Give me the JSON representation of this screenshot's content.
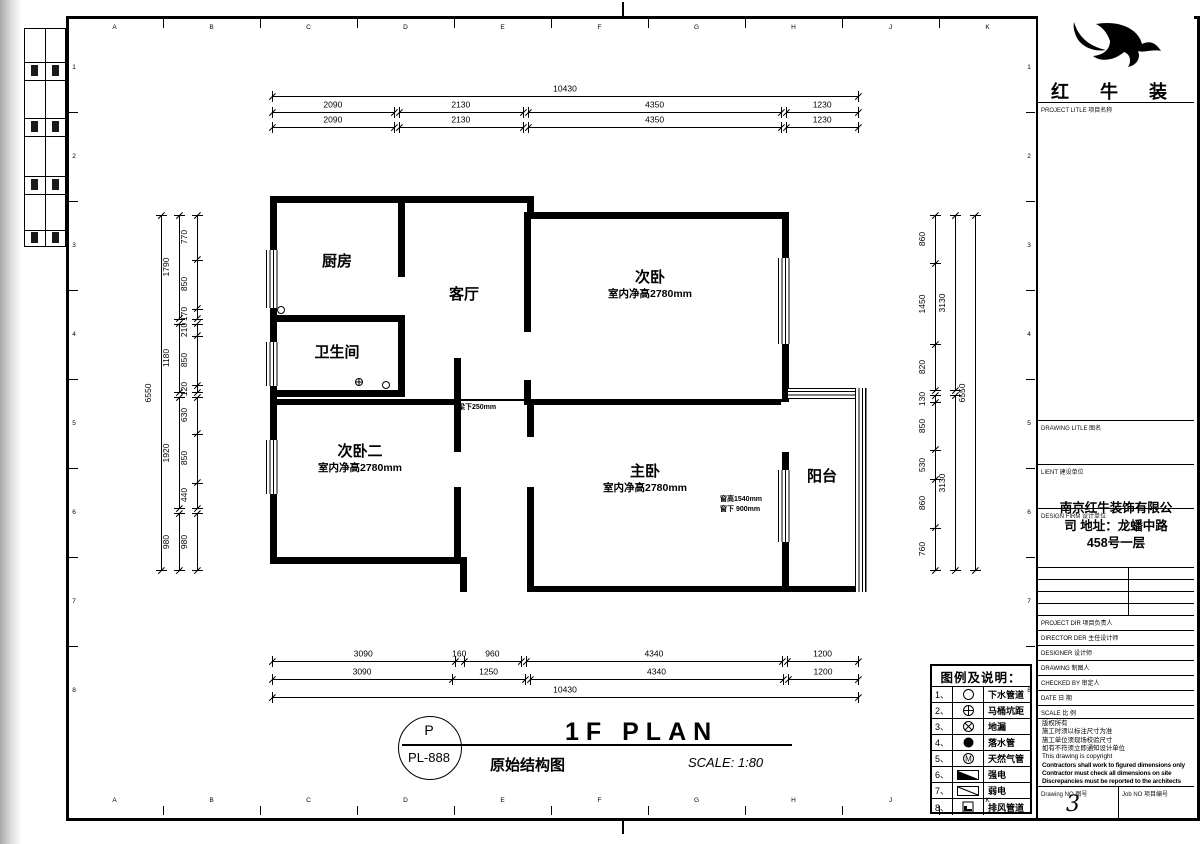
{
  "frame": {
    "grid_letters": [
      "A",
      "B",
      "C",
      "D",
      "E",
      "F",
      "G",
      "H",
      "J",
      "K"
    ],
    "grid_numbers": [
      "1",
      "2",
      "3",
      "4",
      "5",
      "6",
      "7",
      "8"
    ]
  },
  "plan": {
    "rooms": [
      {
        "name": "厨房"
      },
      {
        "name": "客厅"
      },
      {
        "name": "卫生间"
      },
      {
        "name": "次卧",
        "note": "室内净高2780mm"
      },
      {
        "name": "次卧二",
        "note": "室内净高2780mm"
      },
      {
        "name": "主卧",
        "note": "室内净高2780mm"
      },
      {
        "name": "阳台"
      }
    ],
    "beam_note": "梁下250mm",
    "window_note_1": "窗高1540mm",
    "window_note_2": "窗下 900mm"
  },
  "dimensions": {
    "chains": [
      {
        "dir": "h",
        "x": 272,
        "y": 97,
        "len": 586,
        "runs": [
          [
            10430
          ]
        ]
      },
      {
        "dir": "h",
        "x": 272,
        "y": 113,
        "len": 586,
        "runs": [
          [
            2090
          ],
          [
            2130
          ],
          [
            4350
          ],
          [
            1230
          ]
        ]
      },
      {
        "dir": "h",
        "x": 272,
        "y": 128,
        "len": 586,
        "runs": [
          [
            2090
          ],
          [
            2130
          ],
          [
            4350
          ],
          [
            1230
          ]
        ]
      },
      {
        "dir": "h",
        "x": 272,
        "y": 662,
        "len": 586,
        "runs": [
          [
            3090,
            160,
            960
          ],
          [
            4340
          ],
          [
            1200
          ]
        ]
      },
      {
        "dir": "h",
        "x": 272,
        "y": 680,
        "len": 586,
        "runs": [
          [
            3090,
            1250
          ],
          [
            4340
          ],
          [
            1200
          ]
        ]
      },
      {
        "dir": "h",
        "x": 272,
        "y": 698,
        "len": 586,
        "runs": [
          [
            10430
          ]
        ]
      },
      {
        "dir": "v",
        "x": 162,
        "y": 215,
        "len": 355,
        "runs": [
          [
            6550
          ]
        ]
      },
      {
        "dir": "v",
        "x": 180,
        "y": 215,
        "len": 355,
        "runs": [
          [
            1790
          ],
          [
            1180
          ],
          [
            1920
          ],
          [
            980
          ]
        ]
      },
      {
        "dir": "v",
        "x": 198,
        "y": 215,
        "len": 355,
        "runs": [
          [
            770,
            850,
            170
          ],
          [
            210,
            850,
            120
          ],
          [
            630,
            850,
            440
          ],
          [
            980
          ]
        ]
      },
      {
        "dir": "v",
        "x": 936,
        "y": 215,
        "len": 355,
        "runs": [
          [
            860,
            1450,
            820
          ],
          [
            130,
            850,
            530,
            860,
            760
          ]
        ]
      },
      {
        "dir": "v",
        "x": 956,
        "y": 215,
        "len": 355,
        "runs": [
          [
            3130
          ],
          [
            3130
          ]
        ]
      },
      {
        "dir": "v",
        "x": 976,
        "y": 215,
        "len": 355,
        "runs": [
          [
            6550
          ]
        ]
      }
    ]
  },
  "legend": {
    "title": "图例及说明：",
    "items": [
      {
        "no": "1、",
        "symbol": "circle",
        "label": "下水管道"
      },
      {
        "no": "2、",
        "symbol": "circle-plus",
        "label": "马桶坑距"
      },
      {
        "no": "3、",
        "symbol": "circle-x",
        "label": "地漏"
      },
      {
        "no": "4、",
        "symbol": "circle-filled",
        "label": "落水管"
      },
      {
        "no": "5、",
        "symbol": "circle-m",
        "label": "天然气管"
      },
      {
        "no": "6、",
        "symbol": "rect-filled-diag",
        "label": "强电"
      },
      {
        "no": "7、",
        "symbol": "rect-diag",
        "label": "弱电"
      },
      {
        "no": "8、",
        "symbol": "square-corner",
        "label": "排风管道"
      }
    ]
  },
  "stamp": {
    "top": "P",
    "code": "PL-888"
  },
  "title_area": {
    "title": "1F PLAN",
    "subtitle": "原始结构图",
    "scale": "SCALE: 1:80"
  },
  "titleblock": {
    "brand": "红 牛 装 饰",
    "project_label": "PROJECT LITLE  项目名称",
    "drawing_label": "DRAWING LITLE  图名",
    "client_label": "LIENT  建设单位",
    "firm_label": "DESIGN FIRM 设计单位",
    "firm_name": "南京红牛装饰有限公司",
    "firm_address": "地址：龙蟠中路 458号一层",
    "rows": [
      "PROJECT DIR  项目负责人",
      "DIRECTOR DER 主任设计师",
      "DESIGNER  设计师",
      "DRAWING  制图人",
      "CHECKED BY  审定人",
      "DATE  日 期",
      "SCALE  比 例"
    ],
    "notes": [
      "版权所有",
      "施工时须以标注尺寸为准",
      "施工单位须现场校验尺寸",
      "如有不符须立即通知设计单位",
      "This drawing is copyright"
    ],
    "notes_en": [
      "Contractors shall work to figured dimensions only",
      "Contractor must check all dimensions on site",
      "Discrepancies must be reported to the architects"
    ],
    "drawing_no_label": "Drawing NO 图号",
    "drawing_no": "3",
    "job_no_label": "Job NO 项目编号"
  }
}
